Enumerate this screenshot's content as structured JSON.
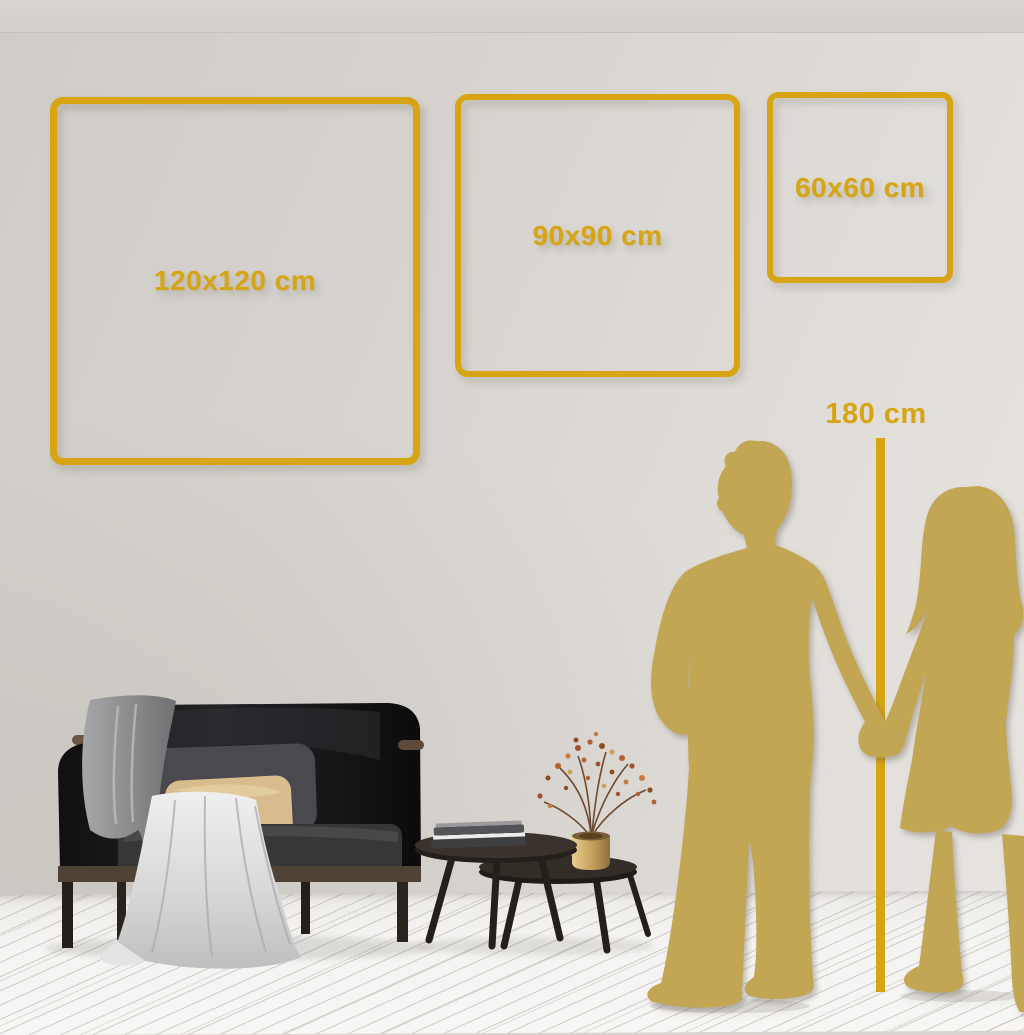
{
  "size_guide": {
    "frames": [
      {
        "size": "large",
        "label": "120x120 cm"
      },
      {
        "size": "medium",
        "label": "90x90 cm"
      },
      {
        "size": "small",
        "label": "60x60 cm"
      }
    ],
    "height_reference": {
      "label": "180 cm"
    }
  },
  "colors": {
    "accent_gold": "#d7a413",
    "silhouette_gold": "#c2a654",
    "wall_light": "#e7e4e0",
    "wall_dark": "#cfccc7",
    "floor_white": "#f4f3f1",
    "sofa_dark": "#17171a",
    "pillow_beige": "#d8bc8e"
  }
}
